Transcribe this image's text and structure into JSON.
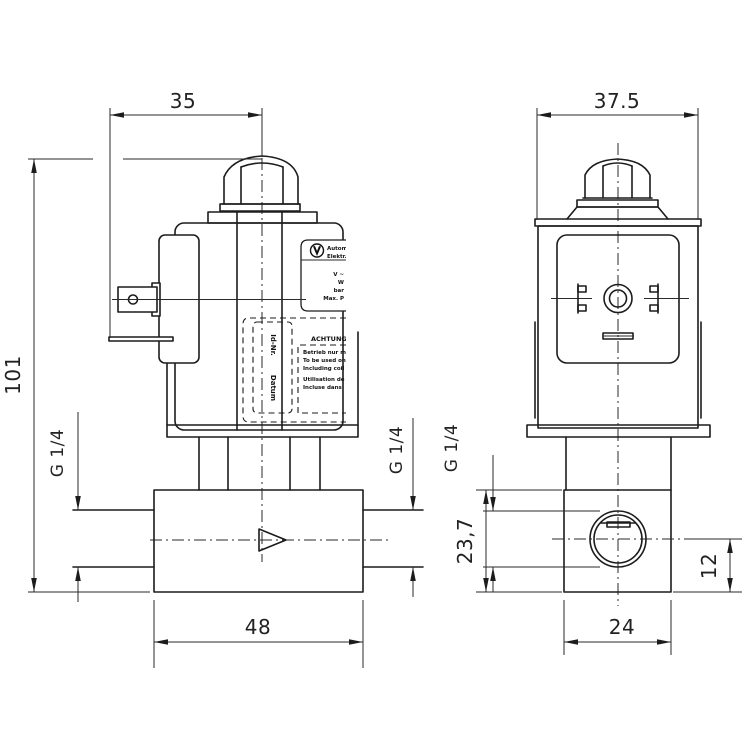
{
  "drawing": {
    "type": "technical-drawing",
    "subject": "solenoid-valve-two-view",
    "colors": {
      "line": "#1c1c1c",
      "background": "#ffffff"
    },
    "dims": {
      "coil_center_offset": "35",
      "coil_width_side": "37.5",
      "overall_height": "101",
      "body_length_front": "48",
      "body_width_side": "24",
      "body_height_side": "23,7",
      "port_axis_height": "12",
      "thread_left": "G 1/4",
      "thread_right": "G 1/4",
      "thread_side": "G 1/4"
    },
    "label": {
      "brand_line1": "Autom.",
      "brand_line2": "Elektr.",
      "spec_lines": [
        "V ~",
        "W",
        "bar",
        "Max. P"
      ],
      "warning_title": "ACHTUNG",
      "warning_lines": [
        "Betrieb nur mit",
        "To be used only",
        "Including coil",
        "Utilisation de la",
        "Incluse dans"
      ],
      "id_label": "Id-Nr.",
      "date_label": "Datum"
    }
  }
}
